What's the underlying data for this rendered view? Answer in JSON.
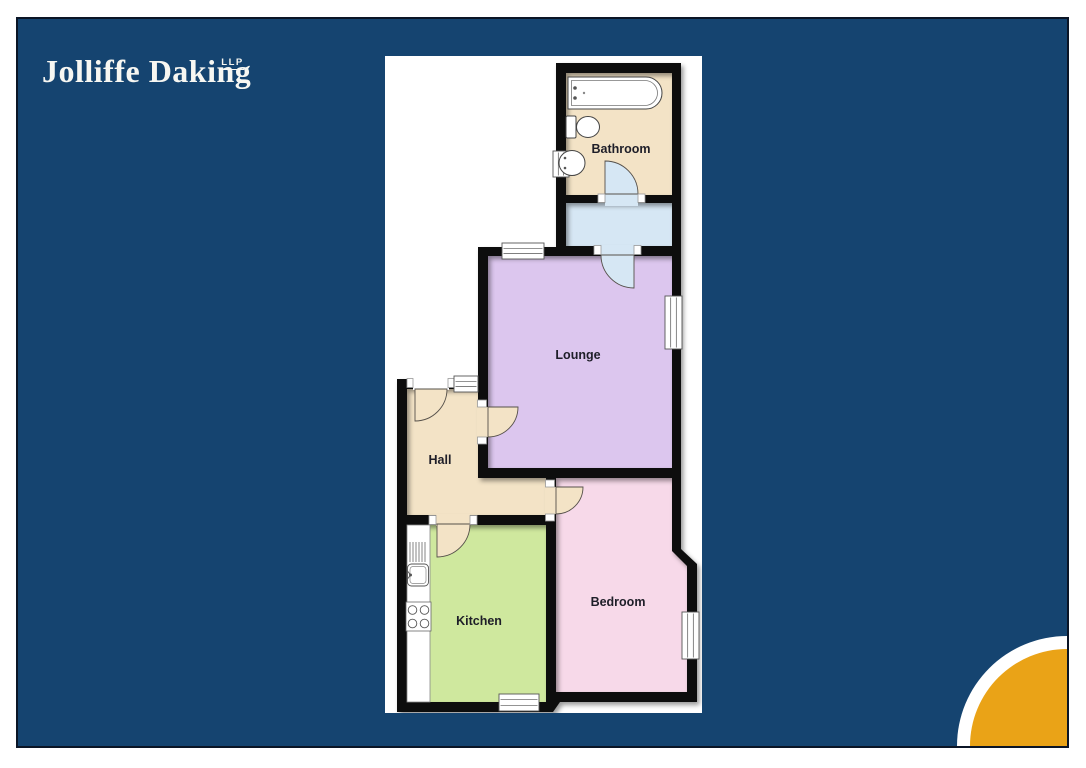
{
  "brand": {
    "name": "Jolliffe Daking",
    "designation": "LLP"
  },
  "floorplan": {
    "rooms": {
      "bathroom": "Bathroom",
      "lounge": "Lounge",
      "hall": "Hall",
      "kitchen": "Kitchen",
      "bedroom": "Bedroom"
    },
    "fixtures": [
      "bath",
      "toilet",
      "basin",
      "kitchen-sink",
      "drainer",
      "hob",
      "worktop"
    ],
    "features": {
      "windows": 6,
      "door_swings": 6
    }
  },
  "colors": {
    "page_background": "#ffffff",
    "panel_navy": "#154470",
    "panel_border": "#0b1526",
    "accent_orange": "#eaa317",
    "plan_background": "#ffffff",
    "wall": "#0d0d0d",
    "floor_bathroom": "#f3e3c6",
    "floor_landing": "#d6e7f4",
    "floor_lounge": "#dcc6ee",
    "floor_hall": "#f3e3c6",
    "floor_kitchen": "#cfe89e",
    "floor_bedroom": "#f7d9e9",
    "logo_text": "#f7f7f2"
  }
}
